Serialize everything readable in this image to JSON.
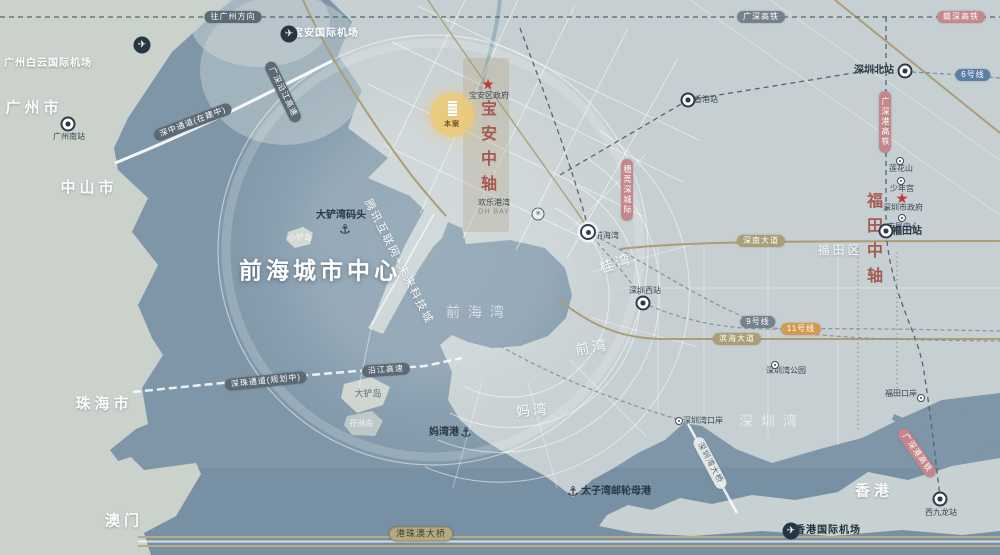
{
  "map": {
    "title": "前海城市中心",
    "colors": {
      "sea": "#7E96A8",
      "land_west": "#CBD2CC",
      "land_east": "#C6CFD1",
      "land_hk": "#C8D1D2",
      "road_tan": "#AB9E76",
      "pill_dark": "#5B6A74",
      "pill_pink": "#C4878C",
      "highlight_yellow": "#EBC97A",
      "axis_red": "#A14F46",
      "star_red": "#BF3A30"
    },
    "project": {
      "n": "project-marker",
      "label": "本案",
      "x": 452,
      "y": 115
    },
    "labels": [
      {
        "n": "title-qianhai-city-center",
        "t": "前海城市中心",
        "x": 320,
        "y": 271,
        "c": "title"
      },
      {
        "n": "label-guangzhou-city",
        "t": "广州市",
        "x": 34,
        "y": 108,
        "c": "city"
      },
      {
        "n": "label-zhongshan-city",
        "t": "中山市",
        "x": 89,
        "y": 188,
        "c": "city"
      },
      {
        "n": "label-zhuhai-city",
        "t": "珠海市",
        "x": 104,
        "y": 404,
        "c": "city"
      },
      {
        "n": "label-macau",
        "t": "澳门",
        "x": 124,
        "y": 521,
        "c": "city"
      },
      {
        "n": "label-hongkong",
        "t": "香港",
        "x": 874,
        "y": 491,
        "c": "city"
      },
      {
        "n": "label-futian-district",
        "t": "福田区",
        "x": 840,
        "y": 250,
        "c": "city2"
      },
      {
        "n": "label-qianhai-bay",
        "t": "前海湾",
        "x": 479,
        "y": 312,
        "c": "bay"
      },
      {
        "n": "label-shenzhen-bay",
        "t": "深圳湾",
        "x": 772,
        "y": 421,
        "c": "bay"
      },
      {
        "n": "label-guiwan",
        "t": "桂湾",
        "x": 616,
        "y": 263,
        "c": "district",
        "r": -18
      },
      {
        "n": "label-qianwan",
        "t": "前湾",
        "x": 592,
        "y": 347,
        "c": "district",
        "r": -10
      },
      {
        "n": "label-mawan",
        "t": "妈湾",
        "x": 533,
        "y": 410,
        "c": "district",
        "r": -5
      },
      {
        "n": "label-tencent-city",
        "t": "腾讯互联网+未来科技城",
        "x": 398,
        "y": 262,
        "c": "area-rot",
        "r": 63
      },
      {
        "n": "label-xiaochan-island",
        "t": "小铲岛",
        "x": 300,
        "y": 238,
        "c": "island"
      },
      {
        "n": "label-dachan-island",
        "t": "大铲岛",
        "x": 368,
        "y": 394,
        "c": "island-dark"
      },
      {
        "n": "label-mazhou-island",
        "t": "孖洲岛",
        "x": 361,
        "y": 424,
        "c": "island"
      },
      {
        "n": "label-ohbay",
        "t": "欢乐港湾",
        "x": 494,
        "y": 203,
        "c": "tiny-dark"
      },
      {
        "n": "label-ohbay-en",
        "t": "OH BAY",
        "x": 494,
        "y": 212,
        "c": "tiny-en"
      },
      {
        "n": "label-dachan-wharf",
        "t": "大铲湾码头",
        "x": 341,
        "y": 216,
        "c": "place-dark"
      },
      {
        "n": "label-baoan-gov",
        "t": "宝安区政府",
        "x": 489,
        "y": 96,
        "c": "tiny-dark"
      },
      {
        "n": "label-shenzhen-gov",
        "t": "深圳市政府",
        "x": 903,
        "y": 208,
        "c": "tiny-dark"
      },
      {
        "n": "label-lianhuashan",
        "t": "莲花山",
        "x": 901,
        "y": 169,
        "c": "tiny-dark"
      },
      {
        "n": "label-shaoniangong",
        "t": "少年宫",
        "x": 902,
        "y": 189,
        "c": "tiny-dark"
      },
      {
        "n": "label-civic-center",
        "t": "市民中心",
        "x": 903,
        "y": 227,
        "c": "tiny-dark"
      },
      {
        "n": "label-qianhaiwan-station",
        "t": "前海湾",
        "x": 607,
        "y": 236,
        "c": "tiny-dark"
      },
      {
        "n": "label-szbay-checkpoint",
        "t": "深圳湾口岸",
        "x": 703,
        "y": 421,
        "c": "tiny-dark"
      },
      {
        "n": "label-futian-checkpoint",
        "t": "福田口岸",
        "x": 901,
        "y": 394,
        "c": "tiny-dark"
      },
      {
        "n": "label-szbay-park",
        "t": "深圳湾公园",
        "x": 786,
        "y": 371,
        "c": "tiny-dark"
      },
      {
        "n": "label-mawan-harbor",
        "t": "妈湾港",
        "x": 444,
        "y": 433,
        "c": "place-dark"
      },
      {
        "n": "label-taiziwan-port",
        "t": "太子湾邮轮母港",
        "x": 616,
        "y": 492,
        "c": "place-dark"
      },
      {
        "n": "label-guangzhounan-station",
        "t": "广州南站",
        "x": 69,
        "y": 137,
        "c": "tiny-dark"
      },
      {
        "n": "label-shenzhenbei-station",
        "t": "深圳北站",
        "x": 874,
        "y": 71,
        "c": "place-dark"
      },
      {
        "n": "label-futian-station",
        "t": "福田站",
        "x": 907,
        "y": 232,
        "c": "place-dark"
      },
      {
        "n": "label-shenzhenxi-station",
        "t": "深圳西站",
        "x": 645,
        "y": 291,
        "c": "tiny-dark"
      },
      {
        "n": "label-xijiulong-station",
        "t": "西九龙站",
        "x": 941,
        "y": 513,
        "c": "tiny-dark"
      },
      {
        "n": "label-hongkong-station",
        "t": "香港站",
        "x": 706,
        "y": 100,
        "c": "tiny-dark"
      },
      {
        "n": "label-gz-airport",
        "t": "广州白云国际机场",
        "x": 48,
        "y": 64,
        "c": "airport-text"
      },
      {
        "n": "label-baoan-airport",
        "t": "宝安国际机场",
        "x": 326,
        "y": 34,
        "c": "airport-text"
      },
      {
        "n": "label-hk-airport",
        "t": "香港国际机场",
        "x": 828,
        "y": 531,
        "c": "airport-text-dark"
      },
      {
        "n": "label-baoan-axis",
        "t": "宝安中轴",
        "x": 486,
        "y": 150,
        "c": "axis"
      },
      {
        "n": "label-futian-axis",
        "t": "福田中轴",
        "x": 872,
        "y": 242,
        "c": "axis"
      }
    ],
    "pills": [
      {
        "n": "pill-shenzhong-corridor",
        "t": "深中通道(在建中)",
        "x": 193,
        "y": 122,
        "c": "pill-dark",
        "r": -21
      },
      {
        "n": "pill-yanjiang-expressway",
        "t": "广深沿江高速",
        "x": 283,
        "y": 92,
        "c": "pill-dark",
        "r": 64
      },
      {
        "n": "pill-shenzhu-corridor",
        "t": "深珠通道(规划中)",
        "x": 266,
        "y": 381,
        "c": "pill-dark",
        "r": -6
      },
      {
        "n": "pill-yanjiang-south",
        "t": "沿江高速",
        "x": 386,
        "y": 370,
        "c": "pill-dark",
        "r": -4
      },
      {
        "n": "pill-hzm-bridge",
        "t": "港珠澳大桥",
        "x": 421,
        "y": 534,
        "c": "pill-tan-light",
        "r": 0
      },
      {
        "n": "pill-szbay-bridge",
        "t": "深圳湾大桥",
        "x": 710,
        "y": 463,
        "c": "pill-light",
        "r": 62
      },
      {
        "n": "pill-shennan-avenue",
        "t": "深南大道",
        "x": 761,
        "y": 241,
        "c": "pill-tan",
        "r": 0
      },
      {
        "n": "pill-binhai-avenue",
        "t": "滨海大道",
        "x": 737,
        "y": 339,
        "c": "pill-tan",
        "r": 0
      },
      {
        "n": "pill-metro-line9",
        "t": "9号线",
        "x": 758,
        "y": 322,
        "c": "pill-gray",
        "r": 0
      },
      {
        "n": "pill-metro-line11",
        "t": "11号线",
        "x": 801,
        "y": 329,
        "c": "pill-orange",
        "r": 0
      },
      {
        "n": "pill-metro-line6",
        "t": "6号线",
        "x": 973,
        "y": 75,
        "c": "pill-blue",
        "r": 0
      },
      {
        "n": "pill-gsg-hsr-vertical",
        "t": "广深港高铁",
        "x": 885,
        "y": 122,
        "c": "pill-pink",
        "vert": true
      },
      {
        "n": "pill-suiguanshen-intercity",
        "t": "穗莞深城际",
        "x": 627,
        "y": 190,
        "c": "pill-pink",
        "vert": true
      },
      {
        "n": "pill-gsg-hsr-south",
        "t": "广深港高铁",
        "x": 917,
        "y": 453,
        "c": "pill-pink",
        "r": 55
      },
      {
        "n": "pill-to-guangzhou",
        "t": "往广州方向",
        "x": 233,
        "y": 17,
        "c": "pill-dark",
        "r": 0
      },
      {
        "n": "pill-guangshen-hsr",
        "t": "广深高铁",
        "x": 761,
        "y": 17,
        "c": "pill-gray",
        "r": 0
      },
      {
        "n": "pill-ganshen-hsr",
        "t": "赣深高铁",
        "x": 961,
        "y": 17,
        "c": "pill-pink",
        "r": 0
      }
    ],
    "icons": [
      {
        "n": "gz-airport-icon",
        "k": "airport",
        "x": 142,
        "y": 45
      },
      {
        "n": "baoan-airport-icon",
        "k": "airport",
        "x": 289,
        "y": 34
      },
      {
        "n": "hk-airport-icon",
        "k": "airport",
        "x": 791,
        "y": 531
      },
      {
        "n": "guangzhounan-station-icon",
        "k": "station",
        "x": 68,
        "y": 124
      },
      {
        "n": "shenzhenbei-station-icon",
        "k": "station",
        "x": 905,
        "y": 71
      },
      {
        "n": "futian-station-icon",
        "k": "station",
        "x": 886,
        "y": 231
      },
      {
        "n": "shenzhenxi-station-icon",
        "k": "station",
        "x": 643,
        "y": 303
      },
      {
        "n": "xijiulong-station-icon",
        "k": "station",
        "x": 940,
        "y": 499
      },
      {
        "n": "hongkong-station-icon",
        "k": "station",
        "x": 688,
        "y": 100
      },
      {
        "n": "qianhaiwan-metro-icon",
        "k": "metro-big",
        "x": 588,
        "y": 232
      },
      {
        "n": "lianhuashan-metro-icon",
        "k": "metro",
        "x": 900,
        "y": 161
      },
      {
        "n": "shaoniangong-metro-icon",
        "k": "metro",
        "x": 901,
        "y": 181
      },
      {
        "n": "civic-center-metro-icon",
        "k": "metro",
        "x": 902,
        "y": 218
      },
      {
        "n": "szbay-checkpoint-icon",
        "k": "metro",
        "x": 679,
        "y": 421
      },
      {
        "n": "futian-checkpoint-icon",
        "k": "metro",
        "x": 921,
        "y": 398
      },
      {
        "n": "szbay-park-icon",
        "k": "metro",
        "x": 775,
        "y": 365
      },
      {
        "n": "mawan-anchor-icon",
        "k": "anchor",
        "x": 466,
        "y": 432
      },
      {
        "n": "taiziwan-anchor-icon",
        "k": "anchor",
        "x": 573,
        "y": 491
      },
      {
        "n": "dachanwan-anchor-icon",
        "k": "anchor",
        "x": 345,
        "y": 229
      },
      {
        "n": "baoan-gov-star-icon",
        "k": "star",
        "x": 488,
        "y": 84
      },
      {
        "n": "shenzhen-gov-star-icon",
        "k": "star",
        "x": 902,
        "y": 198
      },
      {
        "n": "ferris-wheel-icon",
        "k": "ferris",
        "x": 538,
        "y": 214
      }
    ]
  }
}
